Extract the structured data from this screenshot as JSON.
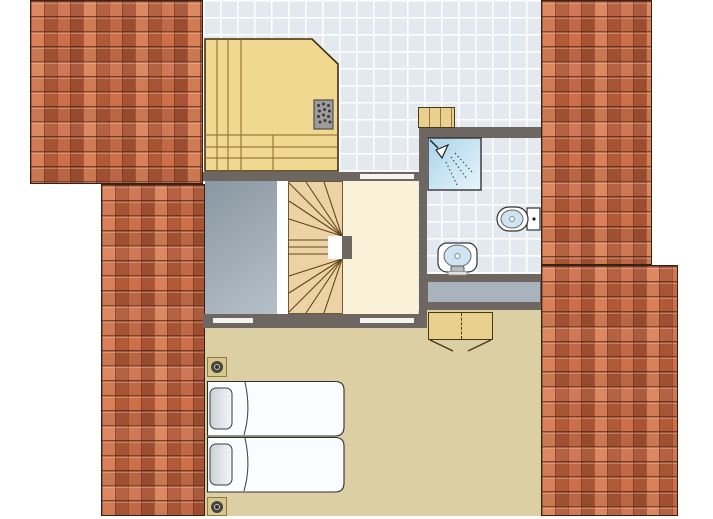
{
  "plan": {
    "kind": "attic-floor-plan",
    "rooms": [
      "hall",
      "sauna",
      "bathroom",
      "stairwell",
      "void",
      "landing",
      "bedroom"
    ],
    "fixtures": [
      "sauna-heater",
      "shower",
      "toilet",
      "washbasin",
      "wooden-shelf",
      "wardrobe",
      "staircase-winder",
      "dormer-band"
    ],
    "bed_count": 2,
    "pillow_count": 2,
    "spotlight_count": 2,
    "door_opening_count": 3,
    "roof_patch_count": 2
  },
  "colors": {
    "background": "#ffffff",
    "wall": "#6d6661",
    "roof_tile_base": "#c66a46",
    "tile_floor": "#e4e9ef",
    "bedroom_floor": "#dccfa4",
    "landing_floor": "#faf2d8",
    "void_floor": "#9daab4",
    "sauna_wood": "#f0d890",
    "stair_wood": "#edd2a6",
    "wood_outline": "#4a3a14",
    "shower_blue_dark": "#a9d3ea",
    "shower_blue_light": "#e8f6fc",
    "fixture_white": "#ffffff",
    "basin_blue": "#cfe4f2",
    "bed_linen": "#fbfcfe",
    "pillow_grey": "#d3dade",
    "door_marker": "#f3f3f1",
    "dormer_band": "#a9b3bd",
    "heater_grey": "#9c9c9c",
    "shelf_wood": "#e9d08f",
    "spot_square": "#d8c78b",
    "white_strip": "#ffffff"
  }
}
